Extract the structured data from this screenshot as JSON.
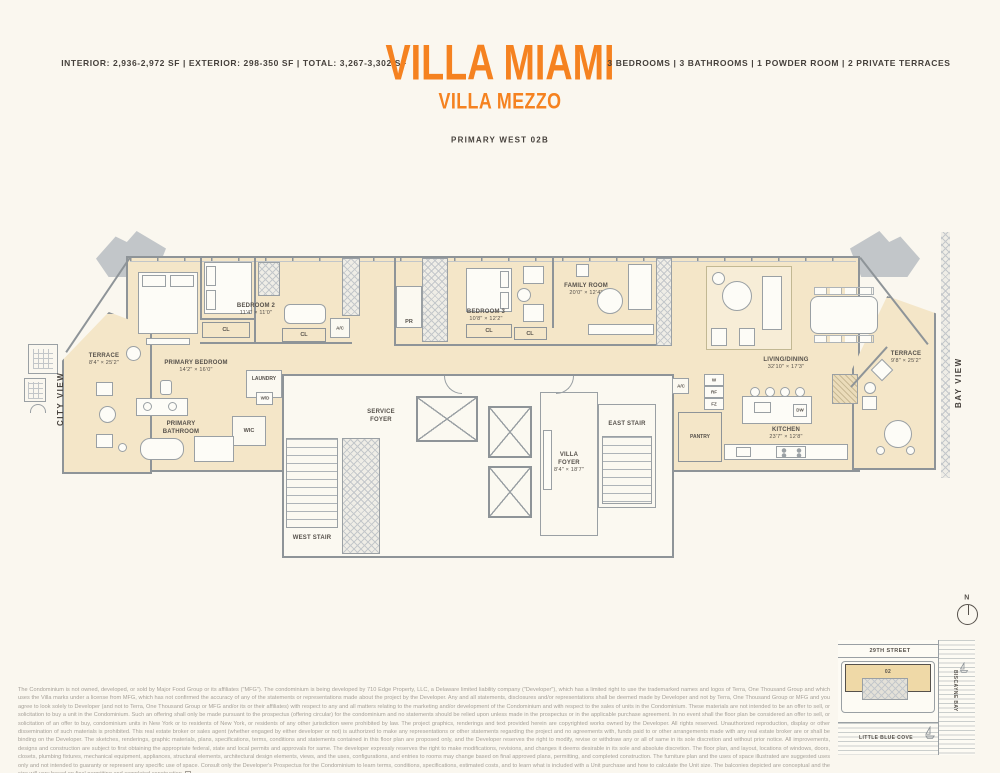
{
  "header": {
    "stats_left": "INTERIOR: 2,936-2,972 SF | EXTERIOR: 298-350 SF | TOTAL: 3,267-3,302 SF",
    "title": "VILLA MIAMI",
    "subtitle": "VILLA MEZZO",
    "unit_name": "PRIMARY WEST 02B",
    "stats_right": "3 BEDROOMS | 3 BATHROOMS | 1 POWDER ROOM | 2 PRIVATE TERRACES"
  },
  "accent_color": "#F58220",
  "views": {
    "left": "CITY VIEW",
    "right": "BAY VIEW"
  },
  "rooms": {
    "terrace_west": {
      "name": "TERRACE",
      "dims": "8'4\" × 25'2\""
    },
    "primary_bedroom": {
      "name": "PRIMARY BEDROOM",
      "dims": "14'2\" × 16'0\""
    },
    "bedroom_2": {
      "name": "BEDROOM 2",
      "dims": "11'4\" × 11'0\""
    },
    "bedroom_3": {
      "name": "BEDROOM 3",
      "dims": "10'8\" × 12'2\""
    },
    "family_room": {
      "name": "FAMILY ROOM",
      "dims": "20'0\" × 12'4\""
    },
    "living_dining": {
      "name": "LIVING/DINING",
      "dims": "32'10\" × 17'3\""
    },
    "kitchen": {
      "name": "KITCHEN",
      "dims": "23'7\" × 12'8\""
    },
    "villa_foyer": {
      "name": "VILLA FOYER",
      "dims": "8'4\" × 18'7\""
    },
    "terrace_east": {
      "name": "TERRACE",
      "dims": "9'8\" × 25'2\""
    },
    "primary_bathroom": {
      "name": "PRIMARY BATHROOM"
    },
    "service_foyer": {
      "name": "SERVICE FOYER"
    },
    "west_stair": {
      "name": "WEST STAIR"
    },
    "east_stair": {
      "name": "EAST STAIR"
    },
    "laundry": {
      "name": "LAUNDRY"
    },
    "pantry": {
      "name": "PANTRY"
    }
  },
  "small_labels": {
    "cl": "CL",
    "ac": "A/C",
    "pr": "PR",
    "wd": "W/D",
    "wic": "WIC",
    "dw": "DW",
    "w": "W",
    "rf": "RF",
    "fz": "FZ"
  },
  "sitemap": {
    "north": "N",
    "street": "29TH STREET",
    "unit": "02",
    "bay": "BISCAYNE BAY",
    "cove": "LITTLE BLUE COVE"
  },
  "disclaimer": "The Condominium is not owned, developed, or sold by Major Food Group or its affiliates (\"MFG\"). The condominium is being developed by 710 Edge Property, LLC, a Delaware limited liability company (\"Developer\"), which has a limited right to use the trademarked names and logos of Terra, One Thousand Group and which uses the Villa marks under a license from MFG, which has not confirmed the accuracy of any of the statements or representations made about the project by the Developer. Any and all statements, disclosures and/or representations shall be deemed made by Developer and not by Terra, One Thousand Group or MFG and you agree to look solely to Developer (and not to Terra, One Thousand Group or MFG and/or its or their affiliates) with respect to any and all matters relating to the marketing and/or development of the Condominium and with respect to the sales of units in the Condominium. These materials are not intended to be an offer to sell, or solicitation to buy a unit in the Condominium. Such an offering shall only be made pursuant to the prospectus (offering circular) for the condominium and no statements should be relied upon unless made in the prospectus or in the applicable purchase agreement. In no event shall the floor plan be considered an offer to sell, or solicitation of an offer to buy, condominium units in New York or to residents of New York, or residents of any other jurisdiction were prohibited by law. The project graphics, renderings and text provided herein are copyrighted works owned by the Developer. All rights reserved. Unauthorized reproduction, display or other dissemination of such materials is prohibited. This real estate broker or sales agent (whether engaged by either developer or not) is authorized to make any representations or other statements regarding the project and no agreements with, funds paid to or other arrangements made with any real estate broker are or shall be binding on the Developer. The sketches, renderings, graphic materials, plans, specifications, terms, conditions and statements contained in this floor plan are proposed only, and the Developer reserves the right to modify, revise or withdraw any or all of same in its sole discretion and without prior notice. All improvements, designs and construction are subject to first obtaining the appropriate federal, state and local permits and approvals for same. The developer expressly reserves the right to make modifications, revisions, and changes it deems desirable in its sole and absolute discretion. The floor plan, and layout, locations of windows, doors, closets, plumbing fixtures, mechanical equipment, appliances, structural elements, architectural design elements, views, and the uses, configurations, and entries to rooms may change based on final approved plans, permitting, and completed construction. The furniture plan and the uses of space illustrated are suggested uses only and not intended to guaranty or represent any specific use of space. Consult only the Developer's Prospectus for the Condominium to learn terms, conditions, specifications, estimated costs, and to learn what is included with a Unit purchase and how to calculate the Unit size. The balconies depicted are conceptual and the size will vary based on final permitting and completed construction."
}
